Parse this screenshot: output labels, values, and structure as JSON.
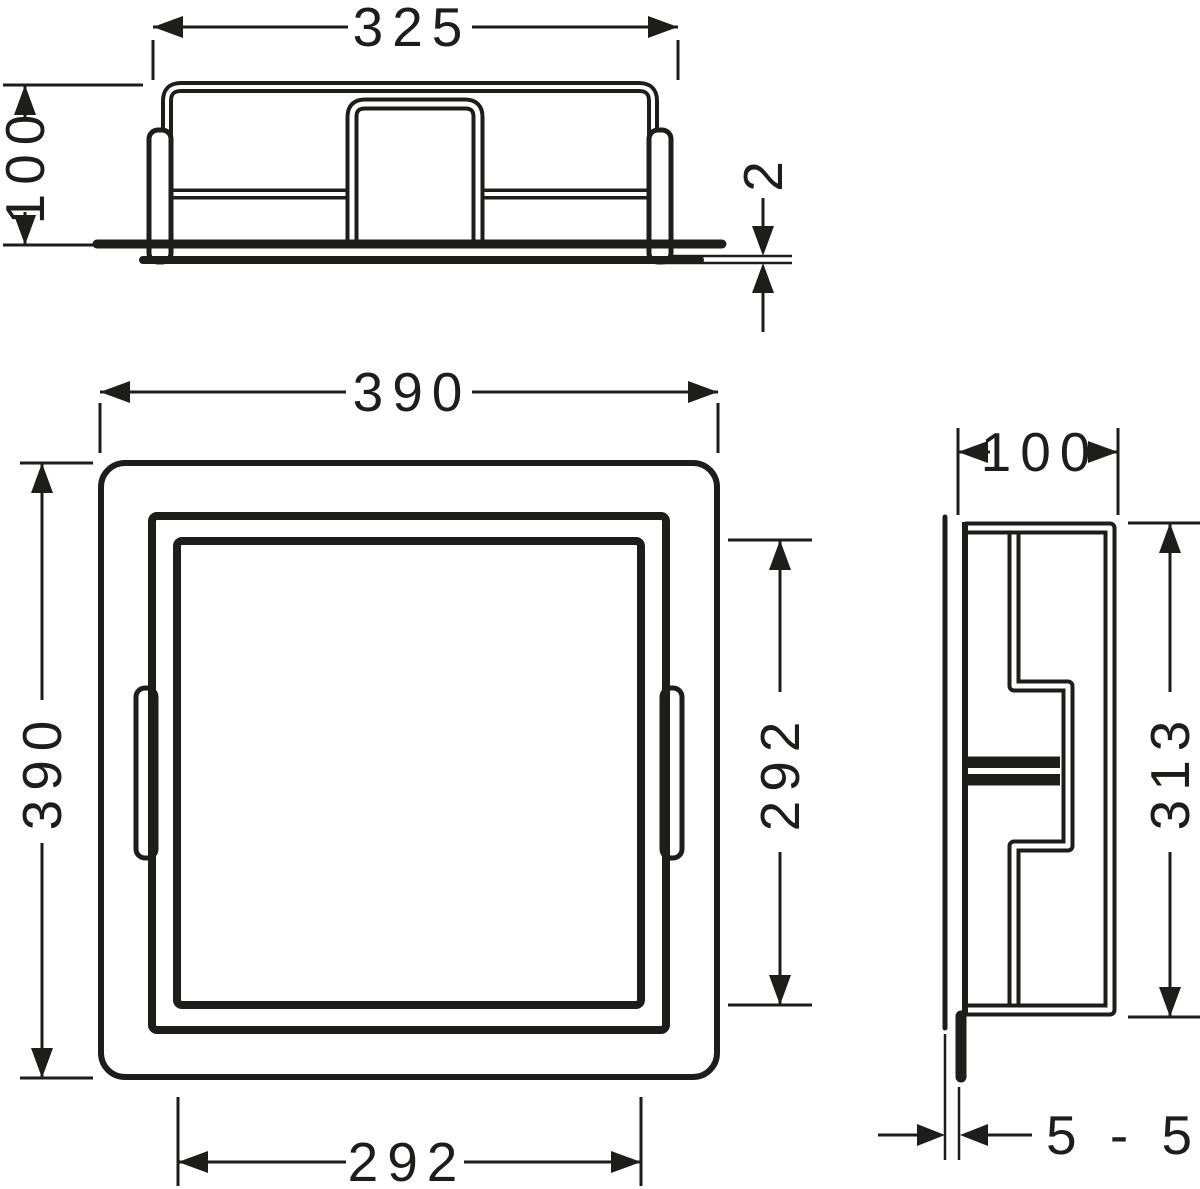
{
  "colors": {
    "background": "#ffffff",
    "line": "#1d1d1b"
  },
  "dimensions": {
    "top_view": {
      "width": "325",
      "height": "100",
      "flange_thickness": "2"
    },
    "front_view": {
      "outer_width": "390",
      "outer_height": "390",
      "inner_height": "292",
      "inner_width": "292"
    },
    "side_view": {
      "depth": "100",
      "height": "313",
      "install_depth_range": "5 - 55"
    }
  }
}
